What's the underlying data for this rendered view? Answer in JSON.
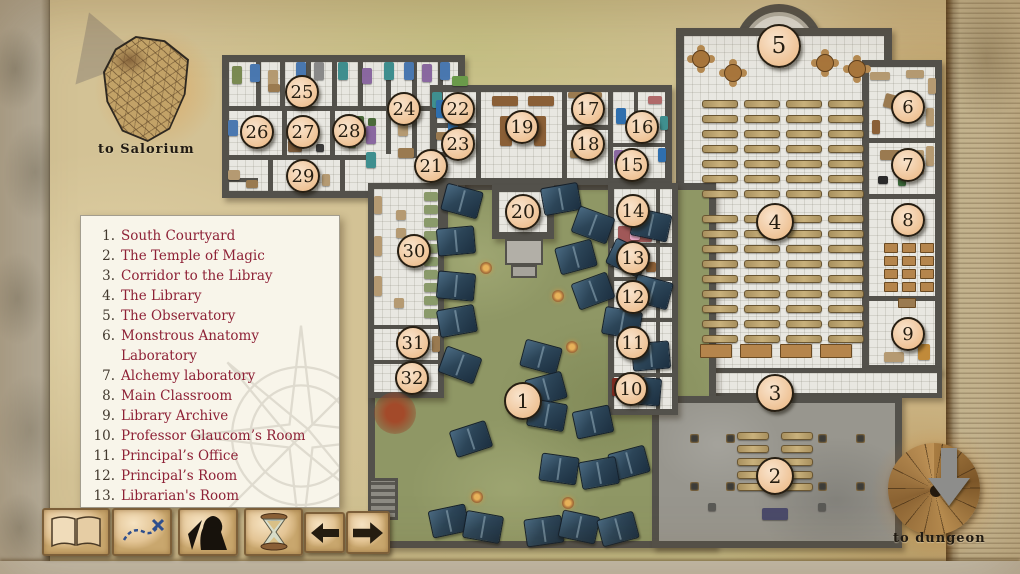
{
  "title": "Magic school floor map",
  "labels": {
    "salorium": "to Salorium",
    "dungeon": "to dungeon"
  },
  "colors": {
    "parchment": "#d3c295",
    "wall": "#53514b",
    "grass": "#8f9765",
    "stone": "#98968e",
    "floor": "#e8e7e1",
    "marker_fill": "#eec193",
    "legend_text": "#8e2136",
    "tent": "#2c4558"
  },
  "legend": {
    "items": [
      {
        "num": "1.",
        "label": "South Courtyard"
      },
      {
        "num": "2.",
        "label": "The Temple of Magic"
      },
      {
        "num": "3.",
        "label": "Corridor to the Libray"
      },
      {
        "num": "4.",
        "label": "The Library"
      },
      {
        "num": "5.",
        "label": "The Observatory"
      },
      {
        "num": "6.",
        "label": "Monstrous Anatomy Laboratory"
      },
      {
        "num": "7.",
        "label": "Alchemy laboratory"
      },
      {
        "num": "8.",
        "label": "Main Classroom"
      },
      {
        "num": "9.",
        "label": "Library Archive"
      },
      {
        "num": "10.",
        "label": "Professor Glaucom’s Room"
      },
      {
        "num": "11.",
        "label": "Principal’s Office"
      },
      {
        "num": "12.",
        "label": "Principal’s Room"
      },
      {
        "num": "13.",
        "label": "Librarian's Room"
      },
      {
        "num": "14.",
        "label": "Miss Bilwa’s Room"
      }
    ]
  },
  "toolbar": {
    "buttons": [
      {
        "name": "journal-button",
        "icon": "open-book-icon"
      },
      {
        "name": "map-button",
        "icon": "treasure-map-icon"
      },
      {
        "name": "character-button",
        "icon": "warrior-icon"
      },
      {
        "name": "time-button",
        "icon": "hourglass-icon"
      },
      {
        "name": "prev-button",
        "icon": "arrow-left-icon"
      },
      {
        "name": "next-button",
        "icon": "arrow-right-icon"
      }
    ]
  },
  "map": {
    "markers": [
      {
        "n": "1",
        "x": 523,
        "y": 401,
        "r": 19
      },
      {
        "n": "2",
        "x": 775,
        "y": 476,
        "r": 19
      },
      {
        "n": "3",
        "x": 775,
        "y": 393,
        "r": 19
      },
      {
        "n": "4",
        "x": 775,
        "y": 222,
        "r": 19
      },
      {
        "n": "5",
        "x": 779,
        "y": 46,
        "r": 22
      },
      {
        "n": "6",
        "x": 908,
        "y": 107,
        "r": 17
      },
      {
        "n": "7",
        "x": 908,
        "y": 165,
        "r": 17
      },
      {
        "n": "8",
        "x": 908,
        "y": 220,
        "r": 17
      },
      {
        "n": "9",
        "x": 908,
        "y": 334,
        "r": 17
      },
      {
        "n": "10",
        "x": 631,
        "y": 389,
        "r": 17
      },
      {
        "n": "11",
        "x": 633,
        "y": 343,
        "r": 17
      },
      {
        "n": "12",
        "x": 633,
        "y": 297,
        "r": 17
      },
      {
        "n": "13",
        "x": 633,
        "y": 258,
        "r": 17
      },
      {
        "n": "14",
        "x": 633,
        "y": 211,
        "r": 17
      },
      {
        "n": "15",
        "x": 632,
        "y": 165,
        "r": 17
      },
      {
        "n": "16",
        "x": 642,
        "y": 127,
        "r": 17
      },
      {
        "n": "17",
        "x": 588,
        "y": 109,
        "r": 17
      },
      {
        "n": "18",
        "x": 588,
        "y": 144,
        "r": 17
      },
      {
        "n": "19",
        "x": 522,
        "y": 127,
        "r": 17
      },
      {
        "n": "20",
        "x": 523,
        "y": 212,
        "r": 18
      },
      {
        "n": "21",
        "x": 431,
        "y": 166,
        "r": 17
      },
      {
        "n": "22",
        "x": 458,
        "y": 109,
        "r": 17
      },
      {
        "n": "23",
        "x": 458,
        "y": 144,
        "r": 17
      },
      {
        "n": "24",
        "x": 404,
        "y": 109,
        "r": 17
      },
      {
        "n": "25",
        "x": 302,
        "y": 92,
        "r": 17
      },
      {
        "n": "26",
        "x": 257,
        "y": 132,
        "r": 17
      },
      {
        "n": "27",
        "x": 303,
        "y": 132,
        "r": 17
      },
      {
        "n": "28",
        "x": 349,
        "y": 131,
        "r": 17
      },
      {
        "n": "29",
        "x": 303,
        "y": 176,
        "r": 17
      },
      {
        "n": "30",
        "x": 414,
        "y": 251,
        "r": 17
      },
      {
        "n": "31",
        "x": 413,
        "y": 343,
        "r": 17
      },
      {
        "n": "32",
        "x": 412,
        "y": 378,
        "r": 17
      }
    ],
    "tents": [
      [
        461,
        200,
        15
      ],
      [
        560,
        198,
        -10
      ],
      [
        592,
        224,
        20
      ],
      [
        455,
        240,
        -5
      ],
      [
        650,
        224,
        12
      ],
      [
        575,
        256,
        -15
      ],
      [
        627,
        257,
        25
      ],
      [
        455,
        285,
        5
      ],
      [
        592,
        290,
        -20
      ],
      [
        651,
        291,
        15
      ],
      [
        456,
        320,
        -10
      ],
      [
        621,
        322,
        10
      ],
      [
        650,
        355,
        -5
      ],
      [
        540,
        356,
        15
      ],
      [
        459,
        364,
        20
      ],
      [
        545,
        388,
        -15
      ],
      [
        641,
        390,
        5
      ],
      [
        546,
        414,
        10
      ],
      [
        592,
        421,
        -12
      ],
      [
        628,
        462,
        -15
      ],
      [
        470,
        438,
        -18
      ],
      [
        448,
        520,
        -12
      ],
      [
        482,
        526,
        10
      ],
      [
        543,
        530,
        -8
      ],
      [
        578,
        526,
        12
      ],
      [
        617,
        528,
        -15
      ],
      [
        558,
        468,
        8
      ],
      [
        598,
        472,
        -10
      ]
    ],
    "fires": [
      [
        486,
        268
      ],
      [
        558,
        296
      ],
      [
        572,
        347
      ],
      [
        477,
        497
      ],
      [
        568,
        503
      ]
    ],
    "partitions": [
      [
        222,
        106,
        240,
        5
      ],
      [
        222,
        155,
        150,
        5
      ],
      [
        256,
        58,
        5,
        50
      ],
      [
        280,
        58,
        5,
        50
      ],
      [
        306,
        58,
        5,
        50
      ],
      [
        332,
        58,
        5,
        50
      ],
      [
        358,
        58,
        5,
        50
      ],
      [
        386,
        58,
        5,
        96
      ],
      [
        412,
        58,
        5,
        50
      ],
      [
        438,
        58,
        5,
        50
      ],
      [
        282,
        110,
        5,
        48
      ],
      [
        330,
        110,
        5,
        48
      ],
      [
        268,
        158,
        5,
        40
      ],
      [
        340,
        158,
        5,
        40
      ],
      [
        412,
        110,
        5,
        48
      ],
      [
        430,
        152,
        35,
        5
      ],
      [
        222,
        178,
        36,
        4
      ],
      [
        476,
        90,
        5,
        90
      ],
      [
        562,
        90,
        5,
        90
      ],
      [
        608,
        90,
        5,
        90
      ],
      [
        430,
        123,
        48,
        5
      ],
      [
        562,
        125,
        48,
        5
      ],
      [
        634,
        90,
        4,
        40
      ],
      [
        608,
        143,
        64,
        4
      ],
      [
        862,
        138,
        80,
        5
      ],
      [
        862,
        194,
        80,
        5
      ],
      [
        862,
        296,
        80,
        5
      ],
      [
        608,
        243,
        70,
        4
      ],
      [
        608,
        277,
        70,
        4
      ],
      [
        608,
        318,
        70,
        4
      ],
      [
        608,
        373,
        70,
        4
      ],
      [
        656,
        183,
        4,
        232
      ],
      [
        368,
        325,
        76,
        4
      ],
      [
        368,
        360,
        76,
        4
      ],
      [
        444,
        183,
        4,
        56
      ],
      [
        550,
        183,
        4,
        56
      ]
    ],
    "furniture": [
      [
        232,
        66,
        10,
        18,
        "#7a8a52",
        0
      ],
      [
        250,
        64,
        10,
        18,
        "#4a78b0",
        0
      ],
      [
        268,
        70,
        10,
        16,
        "#b59a72",
        0
      ],
      [
        296,
        62,
        10,
        18,
        "#4a78b0",
        0
      ],
      [
        314,
        62,
        10,
        18,
        "#8a8a8a",
        0
      ],
      [
        338,
        62,
        10,
        18,
        "#3f8f8f",
        0
      ],
      [
        362,
        68,
        10,
        16,
        "#8a68a0",
        0
      ],
      [
        384,
        62,
        10,
        18,
        "#3f8f8f",
        0
      ],
      [
        404,
        62,
        10,
        18,
        "#4a78b0",
        0
      ],
      [
        422,
        64,
        10,
        18,
        "#8a68a0",
        0
      ],
      [
        440,
        62,
        10,
        18,
        "#4a78b0",
        0
      ],
      [
        452,
        76,
        16,
        10,
        "#6a9a4a",
        0
      ],
      [
        228,
        120,
        10,
        16,
        "#4a78b0",
        0
      ],
      [
        228,
        170,
        12,
        10,
        "#b59a72",
        0
      ],
      [
        292,
        118,
        22,
        10,
        "#9a7a50",
        0
      ],
      [
        288,
        140,
        14,
        12,
        "#7a5a3a",
        0
      ],
      [
        316,
        144,
        8,
        8,
        "#3a3a3a",
        0
      ],
      [
        344,
        116,
        8,
        8,
        "#4a6a3a",
        0
      ],
      [
        356,
        116,
        8,
        8,
        "#4a6a3a",
        0
      ],
      [
        368,
        118,
        8,
        8,
        "#4a6a3a",
        0
      ],
      [
        348,
        140,
        8,
        8,
        "#4a6a3a",
        0
      ],
      [
        356,
        128,
        18,
        8,
        "#9a7a50",
        0
      ],
      [
        366,
        126,
        10,
        18,
        "#8a68a0",
        0
      ],
      [
        366,
        152,
        10,
        16,
        "#3f8f8f",
        0
      ],
      [
        398,
        120,
        10,
        16,
        "#b59a72",
        0
      ],
      [
        398,
        148,
        16,
        10,
        "#9a7a50",
        0
      ],
      [
        432,
        92,
        10,
        16,
        "#3f8f8f",
        0
      ],
      [
        448,
        116,
        10,
        18,
        "#2f6fae",
        0
      ],
      [
        446,
        146,
        16,
        10,
        "#9a7a50",
        0
      ],
      [
        268,
        84,
        12,
        8,
        "#9a7a50",
        0
      ],
      [
        290,
        168,
        10,
        8,
        "#9a7a50",
        0
      ],
      [
        322,
        174,
        8,
        12,
        "#b59a72",
        0
      ],
      [
        246,
        180,
        12,
        8,
        "#9a7a50",
        0
      ],
      [
        436,
        100,
        10,
        18,
        "#2f6fae",
        0
      ],
      [
        452,
        94,
        12,
        8,
        "#9a7a50",
        0
      ],
      [
        436,
        132,
        14,
        8,
        "#9a7a50",
        0
      ],
      [
        466,
        134,
        8,
        12,
        "#b59a72",
        0
      ],
      [
        492,
        96,
        26,
        10,
        "#8a5f36",
        0
      ],
      [
        528,
        96,
        26,
        10,
        "#8a5f36",
        0
      ],
      [
        500,
        116,
        12,
        30,
        "#8a5f36",
        0
      ],
      [
        534,
        116,
        12,
        30,
        "#8a5f36",
        0
      ],
      [
        568,
        92,
        34,
        6,
        "#9a7a50",
        0
      ],
      [
        570,
        150,
        20,
        8,
        "#9a7a50",
        0
      ],
      [
        616,
        108,
        10,
        16,
        "#2f6fae",
        0
      ],
      [
        648,
        96,
        14,
        8,
        "#b06a6a",
        0
      ],
      [
        660,
        116,
        8,
        14,
        "#3f8f8f",
        0
      ],
      [
        614,
        150,
        10,
        14,
        "#8a68a0",
        0
      ],
      [
        658,
        148,
        8,
        14,
        "#2f6fae",
        0
      ],
      [
        620,
        170,
        12,
        8,
        "#9a7a50",
        0
      ],
      [
        870,
        72,
        20,
        8,
        "#b59a72",
        0
      ],
      [
        906,
        70,
        18,
        8,
        "#b59a72",
        0
      ],
      [
        928,
        78,
        8,
        16,
        "#b59a72",
        0
      ],
      [
        884,
        96,
        26,
        14,
        "#9a7a50",
        15
      ],
      [
        926,
        108,
        8,
        18,
        "#b59a72",
        0
      ],
      [
        872,
        120,
        8,
        14,
        "#8a5f36",
        0
      ],
      [
        880,
        150,
        20,
        10,
        "#9a7a50",
        0
      ],
      [
        926,
        146,
        8,
        20,
        "#b59a72",
        0
      ],
      [
        878,
        176,
        10,
        8,
        "#2a2a2a",
        0
      ],
      [
        898,
        178,
        8,
        8,
        "#3a6a3a",
        0
      ],
      [
        916,
        150,
        8,
        24,
        "#b59a72",
        0
      ],
      [
        884,
        352,
        20,
        10,
        "#b59a72",
        0
      ],
      [
        918,
        344,
        12,
        16,
        "#c08a3a",
        0
      ],
      [
        618,
        226,
        34,
        16,
        "#a05858",
        0
      ],
      [
        630,
        230,
        10,
        10,
        "#e8a8c8",
        0
      ],
      [
        610,
        248,
        8,
        18,
        "#9a9a9a",
        0
      ],
      [
        646,
        262,
        10,
        10,
        "#8a5f36",
        0
      ],
      [
        624,
        282,
        18,
        12,
        "#a04838",
        0
      ],
      [
        628,
        284,
        6,
        8,
        "#e8e8e8",
        0
      ],
      [
        638,
        354,
        15,
        13,
        "#7a4a28",
        0
      ],
      [
        612,
        378,
        10,
        18,
        "#7a2a20",
        0
      ],
      [
        628,
        376,
        16,
        6,
        "#9a7a50",
        0
      ],
      [
        396,
        210,
        10,
        10,
        "#b59a72",
        0
      ],
      [
        396,
        228,
        10,
        10,
        "#b59a72",
        0
      ],
      [
        394,
        298,
        10,
        10,
        "#b59a72",
        0
      ],
      [
        374,
        196,
        8,
        18,
        "#b59a72",
        0
      ],
      [
        374,
        236,
        8,
        20,
        "#b59a72",
        0
      ],
      [
        374,
        276,
        8,
        20,
        "#b59a72",
        0
      ],
      [
        398,
        332,
        26,
        18,
        "#8a5a2a",
        0
      ],
      [
        432,
        336,
        8,
        16,
        "#9a7a50",
        0
      ],
      [
        404,
        368,
        12,
        10,
        "#b59a72",
        0
      ],
      [
        762,
        508,
        26,
        12,
        "#4a4a6a",
        0
      ],
      [
        708,
        503,
        8,
        8,
        "#5a5a56",
        0
      ],
      [
        818,
        503,
        8,
        8,
        "#5a5a56",
        0
      ]
    ],
    "corr30_shelves": {
      "x": 424,
      "y0": 192,
      "step": 13,
      "count": 10,
      "w": 14,
      "h": 9,
      "color": "#8a9a6a"
    },
    "library": {
      "shelf_cols_x": [
        702,
        744,
        786,
        828
      ],
      "shelf_w": 34,
      "group1": {
        "y0": 100,
        "step": 15,
        "rows": 7
      },
      "group2": {
        "y0": 215,
        "step": 15,
        "rows": 9
      },
      "round_tables": [
        [
          700,
          58
        ],
        [
          732,
          72
        ],
        [
          824,
          62
        ],
        [
          856,
          68
        ]
      ],
      "bottom_desks_y": 344,
      "bottom_desks_x": [
        700,
        740,
        780,
        820
      ]
    },
    "temple": {
      "bench_rows_y": [
        432,
        445,
        458,
        471,
        483
      ],
      "bench_cols": [
        {
          "x": 737,
          "w": 30
        },
        {
          "x": 781,
          "w": 30
        }
      ],
      "braziers": [
        [
          690,
          434
        ],
        [
          726,
          434
        ],
        [
          818,
          434
        ],
        [
          856,
          434
        ],
        [
          690,
          482
        ],
        [
          726,
          482
        ],
        [
          818,
          482
        ],
        [
          856,
          482
        ]
      ]
    },
    "classroom": {
      "cols_x": [
        884,
        902,
        920
      ],
      "rows_y": [
        243,
        256,
        269,
        282
      ],
      "w": 12,
      "h": 8,
      "teacher_desk": [
        898,
        298,
        16,
        8
      ]
    }
  }
}
